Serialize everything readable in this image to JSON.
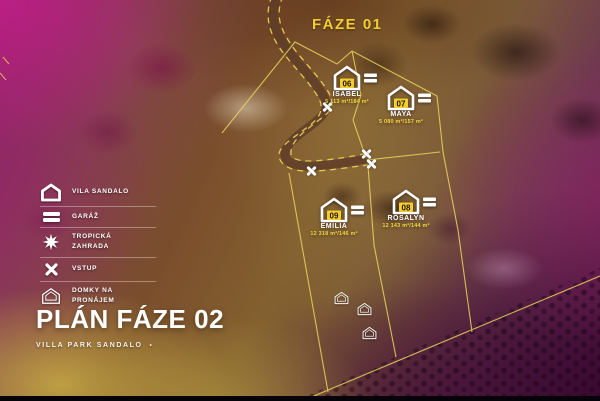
{
  "phase_label": "FÁZE 01",
  "plan": {
    "title": "PLÁN FÁZE 02",
    "subtitle": "VILLA PARK SANDALO",
    "subtitle_mark": "•"
  },
  "legend": {
    "items": [
      {
        "icon": "vila-sandalo-icon",
        "label": "VILA SANDALO"
      },
      {
        "icon": "garaz-icon",
        "label": "GARÁŽ"
      },
      {
        "icon": "tropicka-zahrada-icon",
        "label": "TROPICKÁ ZAHRADA"
      },
      {
        "icon": "vstup-icon",
        "label": "VSTUP"
      },
      {
        "icon": "domky-na-pronajem-icon",
        "label": "DOMKY NA PRONÁJEM"
      }
    ]
  },
  "map": {
    "villas": [
      {
        "number": "06",
        "name": "ISABEL",
        "area": "5 113 m²/184 m²",
        "x": 333,
        "y": 65
      },
      {
        "number": "07",
        "name": "MAYA",
        "area": "5 080 m²/157 m²",
        "x": 387,
        "y": 85
      },
      {
        "number": "09",
        "name": "EMILIA",
        "area": "12 318 m²/146 m²",
        "x": 320,
        "y": 197
      },
      {
        "number": "08",
        "name": "ROSALYN",
        "area": "12 143 m²/144 m²",
        "x": 392,
        "y": 189
      }
    ],
    "entrances": [
      {
        "x": 327,
        "y": 107
      },
      {
        "x": 311,
        "y": 171
      },
      {
        "x": 366,
        "y": 154
      },
      {
        "x": 371,
        "y": 164
      }
    ],
    "rental_houses": [
      {
        "x": 341,
        "y": 298
      },
      {
        "x": 364,
        "y": 309
      },
      {
        "x": 369,
        "y": 333
      }
    ]
  },
  "colors": {
    "accent_yellow": "#f2cf2e",
    "line_yellow": "#ead75c",
    "marker_white": "#ffffff"
  }
}
